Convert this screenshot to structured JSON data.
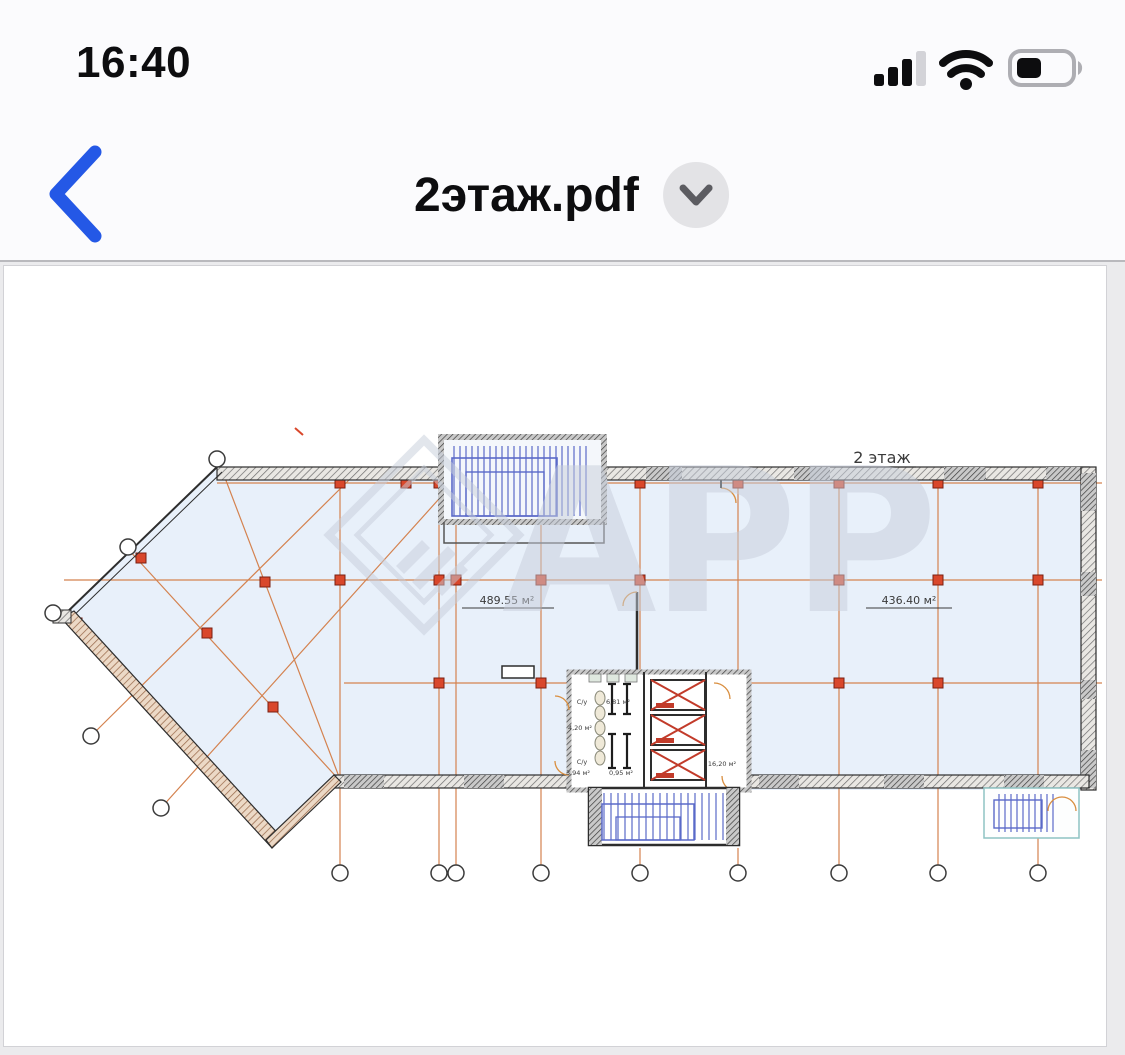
{
  "status_bar": {
    "time": "16:40",
    "cellular_icon": "signal-bars-3of4",
    "wifi_icon": "wifi-full",
    "battery_icon": "battery-40"
  },
  "nav": {
    "title": "2этаж.pdf",
    "back_icon": "chevron-left",
    "menu_icon": "chevron-down"
  },
  "plan": {
    "floor_label": "2 этаж",
    "area_left": "489.55 м²",
    "area_right": "436.40 м²",
    "rooms": {
      "wc_top": "С/у",
      "wc_bottom": "С/у",
      "area_681": "6,81 м²",
      "area_420": "4,20 м²",
      "area_394": "3,94 м²",
      "area_095": "0,95 м²",
      "area_1620": "16,20 м²"
    },
    "watermark": "АРР",
    "colors": {
      "grid_line": "#d4824f",
      "column_marker": "#d9472b",
      "stairs": "#5b6ac9",
      "floor_fill": "#e8f0fa",
      "accent_blue": "#2458e6",
      "watermark_gray": "#c7cedb"
    }
  }
}
